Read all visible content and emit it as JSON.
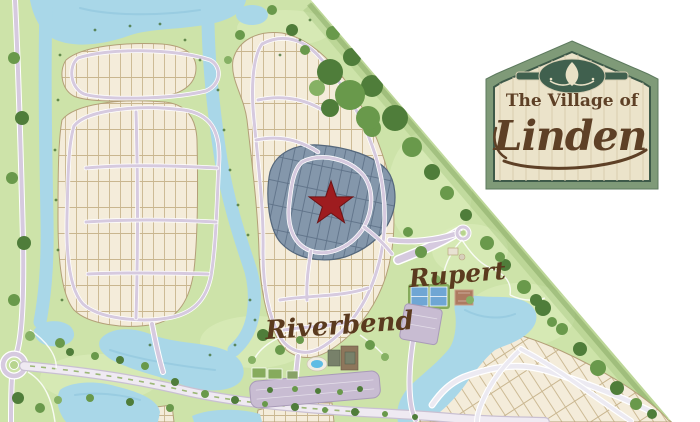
{
  "sign": {
    "line_top": "The Village of",
    "line_main": "Linden",
    "emblem": "linden-leaf-ornament"
  },
  "map": {
    "labels": {
      "park": "Rupert",
      "amenity_village": "Riverbend"
    },
    "marker": {
      "shape": "star",
      "color": "#9e1c1f",
      "meaning": "highlighted-neighborhood"
    },
    "highlight_color": "#8497ab"
  },
  "colors": {
    "water": "#a9d7e8",
    "grass": "#cde3a9",
    "grass_light": "#dcedbc",
    "tree_dark": "#4f7d3a",
    "tree_mid": "#69994b",
    "tree_light": "#86b164",
    "lot_fill": "#f4ecda",
    "lot_line": "#c9b68f",
    "lot_edge": "#b39f78",
    "highlight_line": "#5e7187",
    "road_lavender": "#d6cadf",
    "road_white": "#eceaf2",
    "star_red": "#9e1c1f",
    "label_brown": "#5a3a1e",
    "sign_border_green": "#7f9a78",
    "sign_dark_green": "#3e5a49",
    "sign_panel": "#ebe3ca",
    "sign_plank": "#d8cdae",
    "sign_text_brown": "#5e4026",
    "emblem_green": "#40604e"
  }
}
